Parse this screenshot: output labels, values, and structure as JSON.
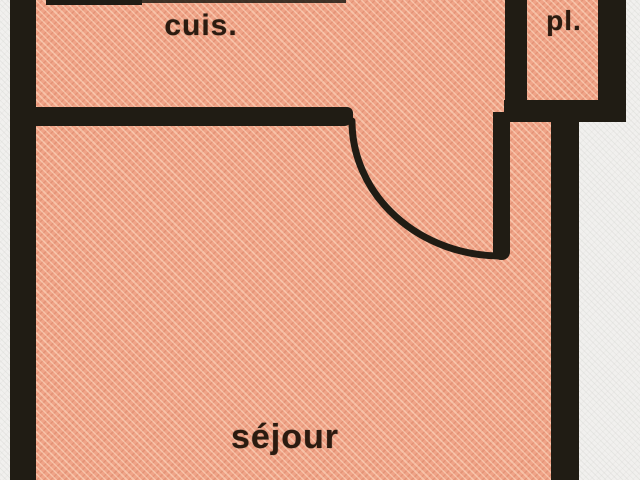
{
  "plan": {
    "type": "apartment-floor-plan",
    "rooms": [
      {
        "name": "cuisine",
        "label": "cuis."
      },
      {
        "name": "placard",
        "label": "pl."
      },
      {
        "name": "sejour",
        "label": "séjour"
      }
    ],
    "colors": {
      "room_fill": "#f0a488",
      "hatch_light": "#f8c9ab",
      "hatch_dark": "#dd8e6f",
      "wall": "#201c14",
      "background": "#f1f0ee",
      "label_text": "#2b1b10"
    }
  }
}
